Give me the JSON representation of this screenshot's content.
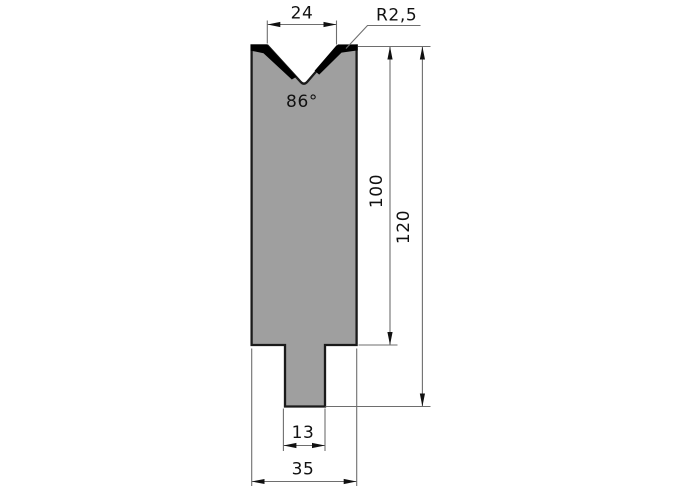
{
  "diagram": {
    "type": "technical-drawing-press-brake-die",
    "labels": {
      "v_opening": "24",
      "tip_radius": "R2,5",
      "v_angle": "86°",
      "height_working": "100",
      "height_total": "120",
      "tang_width": "13",
      "overall_width": "35"
    },
    "colors": {
      "body_fill": "#9F9F9F",
      "hardening_mark": "#000000",
      "outline": "#1A1A1A",
      "dimension_line": "#6E6E6E",
      "arrow": "#111111",
      "background": "#FFFFFF"
    }
  }
}
